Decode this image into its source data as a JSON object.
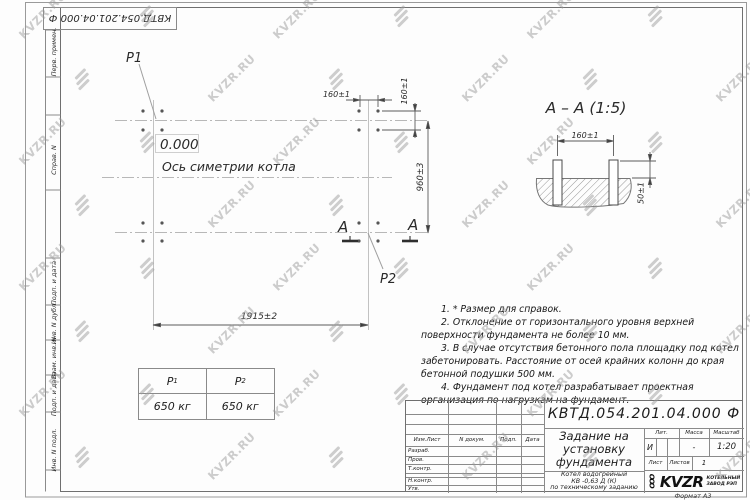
{
  "watermark": {
    "text": "KVZR.RU"
  },
  "frame": {
    "corner_designation": "КВТД.054.201.04.000  Ф",
    "format_label": "Формат А3",
    "margin_labels": [
      "Перв. примен.",
      "Справ. N",
      "Подп. и дата",
      "Инв. N дубл.",
      "Взам. инв. N",
      "Подп. и дата",
      "Инв. N подл."
    ]
  },
  "plan": {
    "point1": "Р1",
    "point2": "Р2",
    "elevation": "0.000",
    "axis_label": "Ось симетрии котла",
    "section_letter": "А",
    "dims": {
      "bolt_spacing_h": "160±1",
      "bolt_spacing_v": "160±1",
      "row_spacing": "960±3",
      "group_spacing": "1915±2"
    }
  },
  "section": {
    "title": "А – А (1:5)",
    "dims": {
      "stud_spacing": "160±1",
      "protrusion": "50±1"
    }
  },
  "notes": [
    "1. * Размер для справок.",
    "2. Отклонение от горизонтального уровня верхней поверхности фундамента не более 10 мм.",
    "3. В случае отсутствия бетонного пола площадку под котел забетонировать. Расстояние от осей крайних колонн до края бетонной подушки 500 мм.",
    "4. Фундамент под котел разрабатывает проектная организация по нагрузкам на фундамент."
  ],
  "load_table": {
    "col1": {
      "symbol": "Р",
      "sub": "1",
      "value": "650 кг"
    },
    "col2": {
      "symbol": "Р",
      "sub": "2",
      "value": "650 кг"
    }
  },
  "title_block": {
    "designation": "КВТД.054.201.04.000  Ф",
    "title_lines": [
      "Задание на",
      "установку",
      "фундамента"
    ],
    "product_lines": [
      "Котел водогрейный",
      "КВ -0,63 Д (К)",
      "по техническому заданию"
    ],
    "columns": [
      "Изм.Лист",
      "N докум.",
      "Подп.",
      "Дата"
    ],
    "rows": [
      "Разраб.",
      "Пров.",
      "Т.контр.",
      "Н.контр.",
      "Утв."
    ],
    "lit": {
      "header": "Лит.",
      "value": "И"
    },
    "mass": {
      "header": "Масса",
      "value": "-"
    },
    "scale": {
      "header": "Масштаб",
      "value": "1:20"
    },
    "sheet": {
      "label": "Лист",
      "value": ""
    },
    "sheets": {
      "label": "Листов",
      "value": "1"
    },
    "company": {
      "prefix": "ООО",
      "abbr": "KVZR",
      "lines": [
        "КОТЕЛЬНЫЙ",
        "ЗАВОД РЭП"
      ]
    }
  }
}
